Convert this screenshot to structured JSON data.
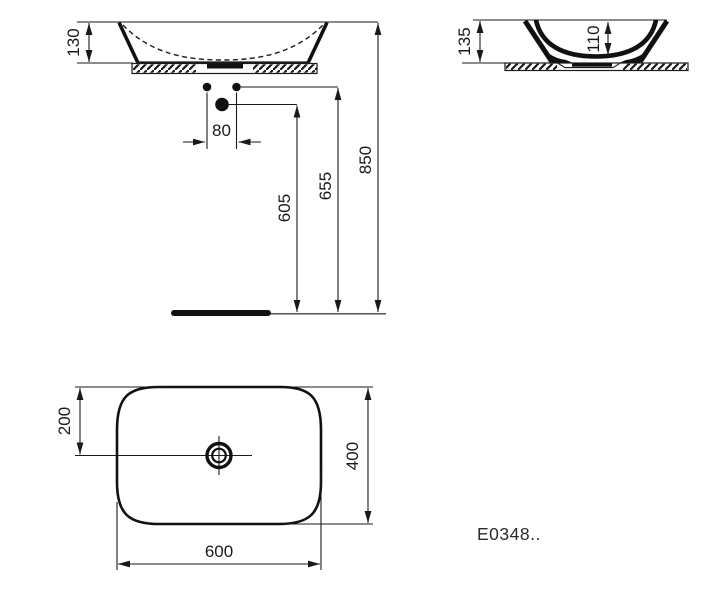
{
  "product_code": "E0348..",
  "front_view": {
    "dims": {
      "basin_height": "130",
      "hole_spacing": "80",
      "mixer_hole_height": "605",
      "tap_hole_height": "655",
      "rim_height": "850"
    }
  },
  "side_view": {
    "dims": {
      "overall_height": "135",
      "bowl_depth": "110"
    }
  },
  "plan_view": {
    "dims": {
      "drain_offset": "200",
      "depth": "400",
      "width": "600"
    }
  },
  "colors": {
    "line": "#1a1a1a",
    "background": "#ffffff"
  }
}
